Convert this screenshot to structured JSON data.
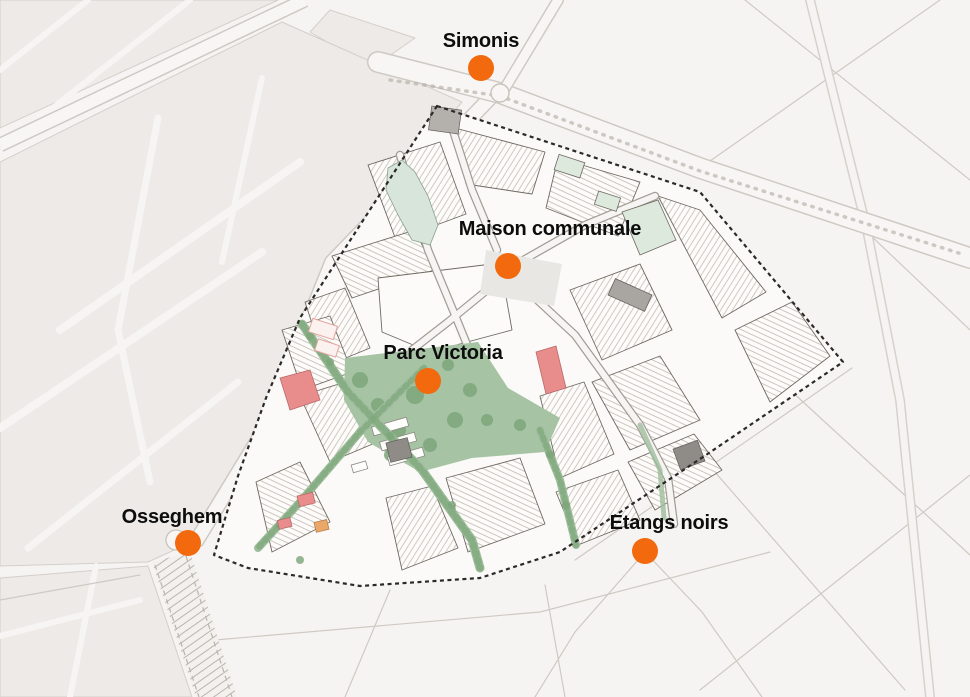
{
  "map": {
    "description": "Urban masterplan map of a study perimeter (dashed boundary) with Parc Victoria and five orange station markers",
    "markers": [
      {
        "id": "simonis",
        "label": "Simonis",
        "x": 481,
        "y": 68,
        "label_dx": 0,
        "label_dy": -27
      },
      {
        "id": "maison-communale",
        "label": "Maison communale",
        "x": 508,
        "y": 266,
        "label_dx": 42,
        "label_dy": -37
      },
      {
        "id": "parc-victoria",
        "label": "Parc Victoria",
        "x": 428,
        "y": 381,
        "label_dx": 15,
        "label_dy": -28
      },
      {
        "id": "osseghem",
        "label": "Osseghem",
        "x": 188,
        "y": 543,
        "label_dx": -16,
        "label_dy": -26
      },
      {
        "id": "etangs-noirs",
        "label": "Etangs noirs",
        "x": 645,
        "y": 551,
        "label_dx": 24,
        "label_dy": -28
      }
    ],
    "colors": {
      "marker_dot": "#f2690e",
      "label_text": "#0d0d0d",
      "background": "#f6f4f2",
      "block_fill": "#edeae7",
      "street_line": "#cfc9c3",
      "boundary_dash": "#2b2a28",
      "park_green": "#a6c3a4",
      "tree_green": "#7da67b",
      "corridor_green": "#9dbd9b",
      "building_red": "#e88c8c",
      "building_orange": "#e9a768",
      "building_dark_gray": "#8f8c88",
      "pond_green": "#d8e5da"
    }
  }
}
